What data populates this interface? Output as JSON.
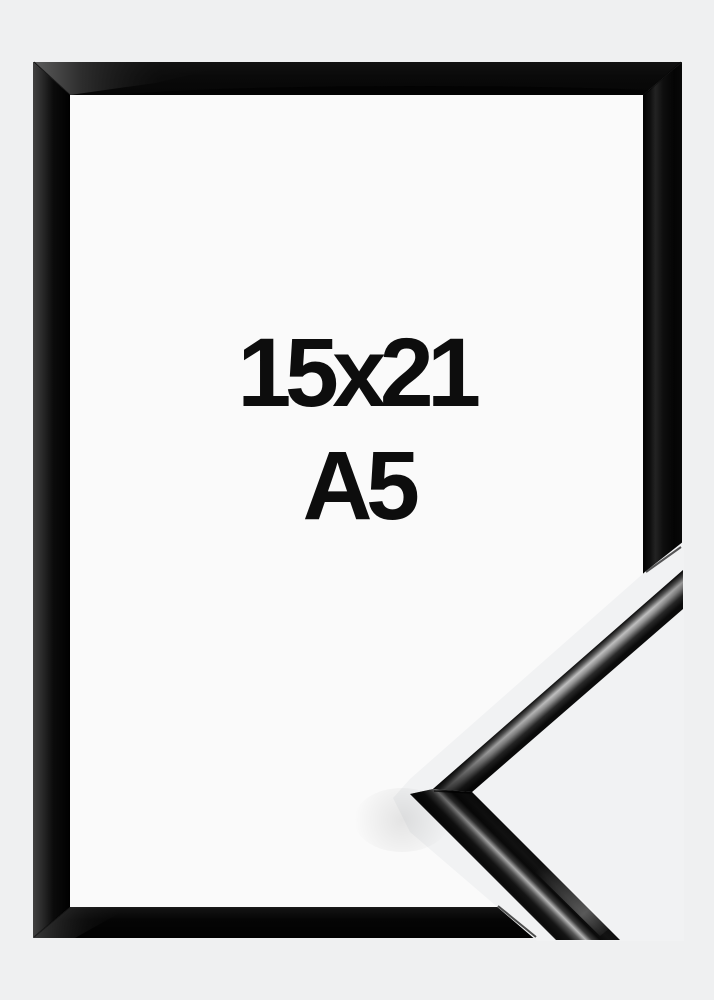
{
  "labels": {
    "size": "15x21",
    "format": "A5"
  },
  "colors": {
    "background": "#eff0f1",
    "frame_opening": "#fafafa",
    "corner_photo_background": "#f1f2f3",
    "frame_black": "#0a0a0a",
    "label_text": "#0d0d0d"
  }
}
